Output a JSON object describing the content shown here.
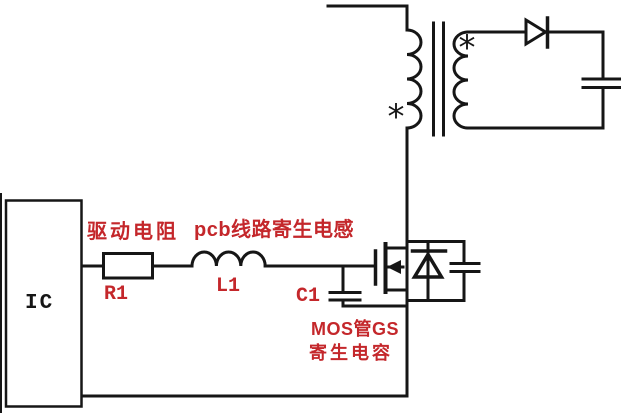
{
  "diagram": {
    "type": "circuit-schematic",
    "description": "Flyback converter gate-drive parasitics schematic",
    "colors": {
      "wire": "#161616",
      "label_red": "#c4272b",
      "background": "#ffffff",
      "component_fill": "#ffffff"
    },
    "labels": {
      "ic": "IC",
      "drive_resistor_caption": "驱动电阻",
      "resistor_ref": "R1",
      "pcb_inductance_caption": "pcb线路寄生电感",
      "inductor_ref": "L1",
      "capacitor_ref": "C1",
      "mos_gs_caption_line1": "MOS管GS",
      "mos_gs_caption_line2": "寄生电容",
      "polarity_marker": "*"
    }
  }
}
